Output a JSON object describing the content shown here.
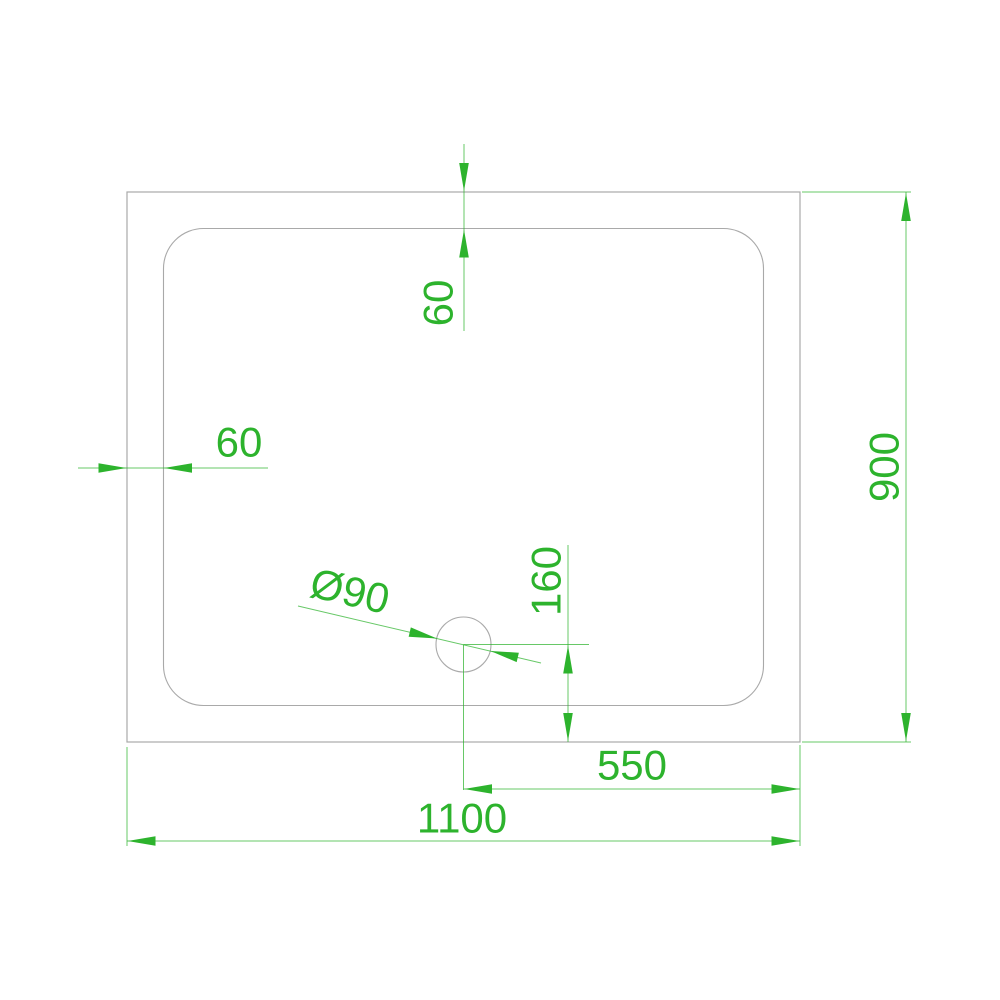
{
  "drawing": {
    "type": "cad-plan-view-shower-tray",
    "labels": {
      "overall_width": "1100",
      "overall_depth": "900",
      "drain_offset_right": "550",
      "drain_offset_bottom": "160",
      "rim_top": "60",
      "rim_left": "60",
      "drain_diameter": "Ø90"
    },
    "colors": {
      "dimension_green": "#2db32d",
      "outline_gray": "#a9a9a9",
      "background": "#ffffff"
    }
  }
}
